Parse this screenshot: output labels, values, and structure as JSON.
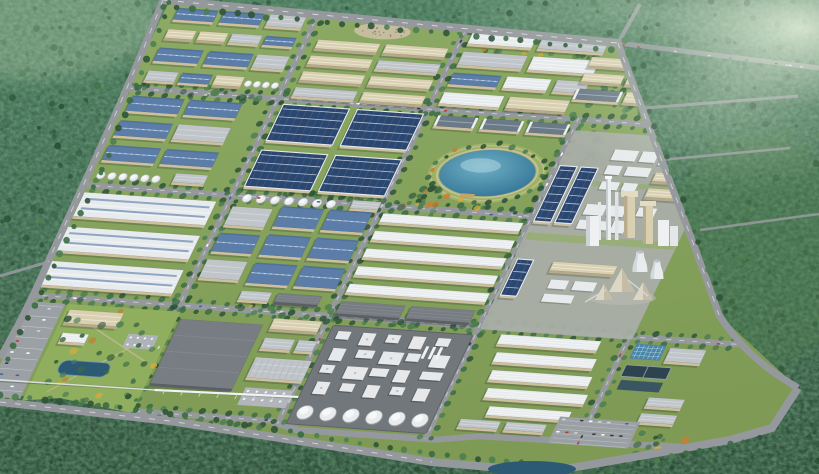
{
  "scene": {
    "title": "Aerial 3D master-plan rendering of an industrial park surrounded by dense forest",
    "description": "Bird's-eye perspective render: a planned industrial zone with gridded tree-lined roads, factory and warehouse blocks, a landscaped lake park, a power plant with chimneys and cooling towers, a chemical plant with storage silos, water-treatment basins, office campus with parking, and forest with future development roads around the perimeter.",
    "palette": {
      "grass": "#86a15a",
      "grass_light": "#97b068",
      "park_green": "#9db465",
      "forest_top": "#3c6a50",
      "forest_mid": "#2f5742",
      "forest_deep": "#1f3d2b",
      "forest_light": "#4f7e52",
      "haze": "#dcead2",
      "road": "#95999d",
      "road_dark": "#7a7f83",
      "road_line": "#ffffff",
      "roof_white": "#e8ebed",
      "roof_white_hi": "#f6f8f9",
      "roof_gray": "#c0c5ca",
      "roof_dark": "#787d83",
      "roof_blue": "#5b7da8",
      "roof_blue_ridge": "#9cb6d2",
      "roof_solar": "#2b4770",
      "solar_line": "#46648e",
      "roof_tan": "#d9d0b2",
      "wall_beige": "#cdbfa0",
      "wall_tan": "#b7a98a",
      "gable_roof": "#6c7a88",
      "water": "#4c93ad",
      "water_deep": "#2f6f94",
      "water_hi": "#bfe0e8",
      "pond": "#2c5a74",
      "basin_blue": "#4b86a8",
      "basin_dark": "#2e4350",
      "tank": "#e9ebec",
      "tank_shade": "#9aa0a0",
      "plant_pad": "#a9aea7",
      "chem_pad": "#72777b",
      "pile": "#ddd6c2",
      "path_tan": "#c9bd9b",
      "tree": "#3c6b45",
      "tree_dark": "#2e5438",
      "tree_light": "#5a8a54",
      "tree_yellow": "#d2ac3e",
      "tree_orange": "#c67f36",
      "car_colors": [
        "#ffffff",
        "#30343a",
        "#b33a32",
        "#3a5f9e",
        "#d8d8d8"
      ]
    },
    "regions": [
      {
        "name": "forest-backdrop",
        "label": "Dense forest surrounding the park"
      },
      {
        "name": "future-plot-roads",
        "label": "Road grid cut through northeast forest"
      },
      {
        "name": "park-grounds",
        "label": "Industrial park grounds"
      },
      {
        "name": "road-network",
        "label": "Tree-lined internal road grid"
      },
      {
        "name": "factories-northwest",
        "label": "Blue-roof factory cluster NW"
      },
      {
        "name": "factories-north",
        "label": "Beige factory rows with laydown yard"
      },
      {
        "name": "factories-northeast",
        "label": "White and gray halls NE"
      },
      {
        "name": "tan-halls-east",
        "label": "Tan halls near NE boundary"
      },
      {
        "name": "factories-west",
        "label": "Blue-roof factories with tank group"
      },
      {
        "name": "solar-roof-plants",
        "label": "Large solar-panel roofed plants"
      },
      {
        "name": "lake-park",
        "label": "Landscaped park with lake"
      },
      {
        "name": "lake",
        "label": "Central lake"
      },
      {
        "name": "power-plant",
        "label": "Power plant with chimneys, cooling towers and stockpiles"
      },
      {
        "name": "warehouses-west",
        "label": "Three large white warehouses"
      },
      {
        "name": "factories-central",
        "label": "Central blue-roof factory grid"
      },
      {
        "name": "logistics-rows-east",
        "label": "Long gray warehouse rows"
      },
      {
        "name": "office-campus",
        "label": "Office campus with lawn, pond and parking"
      },
      {
        "name": "utility-district",
        "label": "Utility buildings and substation"
      },
      {
        "name": "chemical-plant",
        "label": "Chemical plant pad with process units"
      },
      {
        "name": "storage-silos",
        "label": "Row of white storage silos"
      },
      {
        "name": "pipe-bridge",
        "label": "White pipe bridge"
      },
      {
        "name": "water-treatment",
        "label": "Water treatment basins"
      },
      {
        "name": "warehouses-southeast",
        "label": "Southeast white warehouse rows and parking"
      },
      {
        "name": "perimeter-roads",
        "label": "Curved perimeter roads"
      },
      {
        "name": "haze",
        "label": "Atmospheric haze over northeast forest"
      }
    ]
  }
}
